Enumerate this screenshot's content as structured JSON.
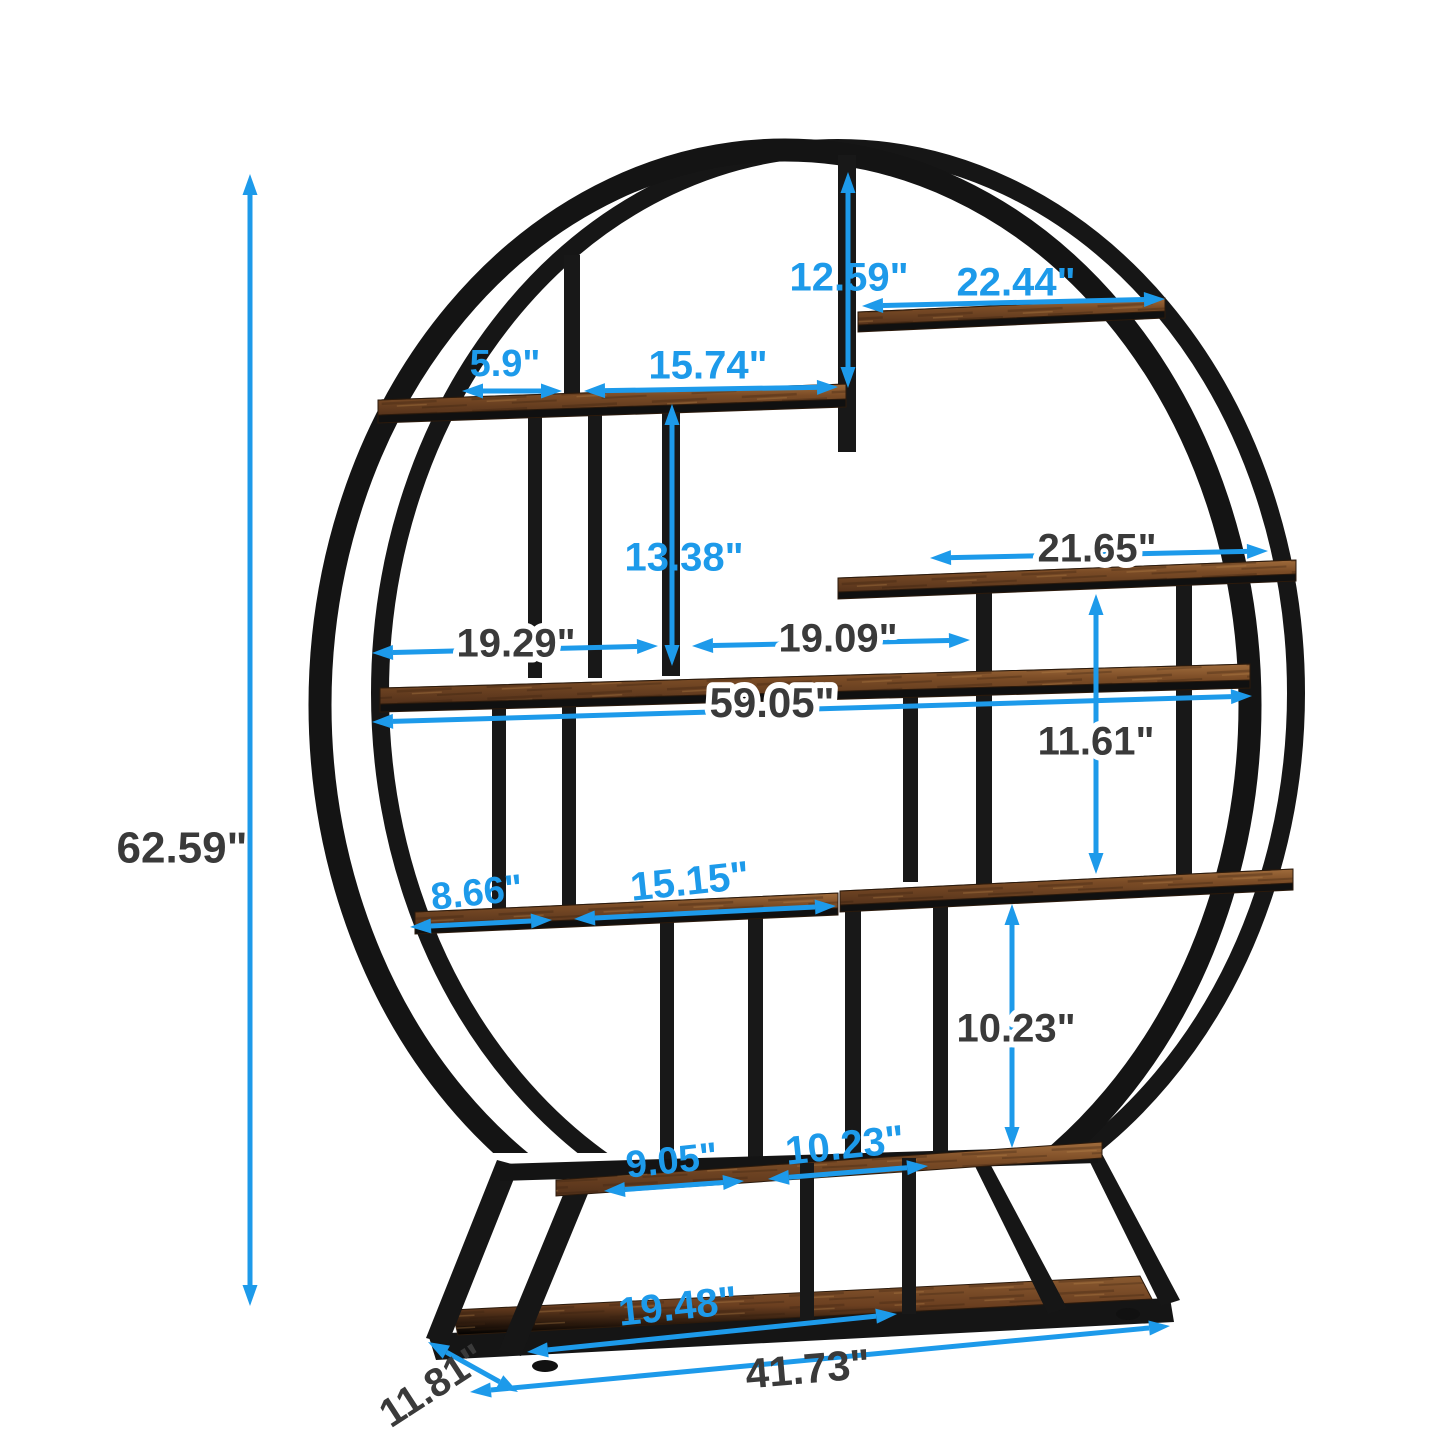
{
  "diagram": {
    "type": "product-dimension-diagram",
    "unit": "inches",
    "colors": {
      "dimension_blue": "#1d9aea",
      "dimension_dark": "#3a3a3a",
      "metal_black": "#1a1a1a",
      "wood_light": "#9c6a3c",
      "wood_mid": "#7b4c26",
      "wood_dark": "#53311a",
      "background": "#ffffff"
    },
    "dimensions": [
      {
        "name": "overall-height",
        "label": "62.59\"",
        "color": "dark",
        "lx": 182,
        "ly": 851,
        "rot": 0,
        "size": 44,
        "halo": false,
        "segments": [
          {
            "x1": 250,
            "y1": 174,
            "x2": 250,
            "y2": 1306,
            "a1": true,
            "a2": true
          }
        ]
      },
      {
        "name": "top-post-height",
        "label": "12.59\"",
        "color": "blue",
        "lx": 849,
        "ly": 280,
        "rot": 0,
        "size": 40,
        "halo": false,
        "segments": [
          {
            "x1": 848,
            "y1": 172,
            "x2": 848,
            "y2": 388,
            "a1": true,
            "a2": true
          }
        ]
      },
      {
        "name": "top-shelf-width",
        "label": "22.44\"",
        "color": "blue",
        "lx": 1016,
        "ly": 285,
        "rot": 0,
        "size": 40,
        "halo": false,
        "segments": [
          {
            "x1": 862,
            "y1": 306,
            "x2": 1165,
            "y2": 299,
            "a1": true,
            "a2": true
          }
        ]
      },
      {
        "name": "upper-shelf-left-segment",
        "label": "5.9\"",
        "color": "blue",
        "lx": 505,
        "ly": 366,
        "rot": 0,
        "size": 38,
        "halo": false,
        "segments": [
          {
            "x1": 462,
            "y1": 391,
            "x2": 562,
            "y2": 391,
            "a1": true,
            "a2": true
          }
        ]
      },
      {
        "name": "upper-shelf-right-segment",
        "label": "15.74\"",
        "color": "blue",
        "lx": 708,
        "ly": 368,
        "rot": 0,
        "size": 40,
        "halo": false,
        "segments": [
          {
            "x1": 584,
            "y1": 391,
            "x2": 838,
            "y2": 387,
            "a1": true,
            "a2": true
          }
        ]
      },
      {
        "name": "mid-post-height",
        "label": "13.38\"",
        "color": "blue",
        "lx": 684,
        "ly": 560,
        "rot": 0,
        "size": 40,
        "halo": false,
        "segments": [
          {
            "x1": 672,
            "y1": 404,
            "x2": 672,
            "y2": 666,
            "a1": true,
            "a2": true
          }
        ]
      },
      {
        "name": "right-shelf-width",
        "label": "21.65\"",
        "color": "dark",
        "lx": 1097,
        "ly": 551,
        "rot": 0,
        "size": 40,
        "halo": true,
        "segments": [
          {
            "x1": 930,
            "y1": 558,
            "x2": 1268,
            "y2": 551,
            "a1": true,
            "a2": true
          }
        ]
      },
      {
        "name": "middle-shelf-left-segment",
        "label": "19.29\"",
        "color": "dark",
        "lx": 516,
        "ly": 646,
        "rot": 0,
        "size": 40,
        "halo": true,
        "segments": [
          {
            "x1": 372,
            "y1": 653,
            "x2": 658,
            "y2": 646,
            "a1": true,
            "a2": true
          }
        ]
      },
      {
        "name": "middle-shelf-right-segment",
        "label": "19.09\"",
        "color": "dark",
        "lx": 838,
        "ly": 641,
        "rot": 0,
        "size": 40,
        "halo": true,
        "segments": [
          {
            "x1": 692,
            "y1": 646,
            "x2": 970,
            "y2": 640,
            "a1": true,
            "a2": true
          }
        ]
      },
      {
        "name": "overall-width",
        "label": "59.05\"",
        "color": "dark",
        "lx": 772,
        "ly": 706,
        "rot": 0,
        "size": 42,
        "halo": true,
        "segments": [
          {
            "x1": 372,
            "y1": 722,
            "x2": 1252,
            "y2": 696,
            "a1": true,
            "a2": true
          }
        ]
      },
      {
        "name": "right-gap-height",
        "label": "11.61\"",
        "color": "dark",
        "lx": 1096,
        "ly": 744,
        "rot": 0,
        "size": 40,
        "halo": true,
        "segments": [
          {
            "x1": 1096,
            "y1": 594,
            "x2": 1096,
            "y2": 874,
            "a1": true,
            "a2": true
          }
        ]
      },
      {
        "name": "lower-shelf-left-segment",
        "label": "8.66\"",
        "color": "blue",
        "lx": 477,
        "ly": 895,
        "rot": -6,
        "size": 38,
        "halo": false,
        "segments": [
          {
            "x1": 410,
            "y1": 927,
            "x2": 552,
            "y2": 920,
            "a1": true,
            "a2": true
          }
        ]
      },
      {
        "name": "lower-shelf-right-segment",
        "label": "15.15\"",
        "color": "blue",
        "lx": 690,
        "ly": 884,
        "rot": -6,
        "size": 40,
        "halo": false,
        "segments": [
          {
            "x1": 574,
            "y1": 919,
            "x2": 836,
            "y2": 906,
            "a1": true,
            "a2": true
          }
        ]
      },
      {
        "name": "lower-right-gap-height",
        "label": "10.23\"",
        "color": "dark",
        "lx": 1016,
        "ly": 1031,
        "rot": 0,
        "size": 40,
        "halo": true,
        "segments": [
          {
            "x1": 1012,
            "y1": 904,
            "x2": 1012,
            "y2": 1148,
            "a1": true,
            "a2": true
          }
        ]
      },
      {
        "name": "bottom-shelf-left-segment",
        "label": "9.05\"",
        "color": "blue",
        "lx": 672,
        "ly": 1163,
        "rot": -6,
        "size": 38,
        "halo": false,
        "segments": [
          {
            "x1": 604,
            "y1": 1191,
            "x2": 744,
            "y2": 1181,
            "a1": true,
            "a2": true
          }
        ]
      },
      {
        "name": "bottom-shelf-right-segment",
        "label": "10.23\"",
        "color": "blue",
        "lx": 845,
        "ly": 1148,
        "rot": -6,
        "size": 40,
        "halo": false,
        "segments": [
          {
            "x1": 768,
            "y1": 1179,
            "x2": 928,
            "y2": 1166,
            "a1": true,
            "a2": true
          }
        ]
      },
      {
        "name": "base-shelf-width",
        "label": "19.48\"",
        "color": "blue",
        "lx": 678,
        "ly": 1309,
        "rot": -6,
        "size": 40,
        "halo": false,
        "segments": [
          {
            "x1": 527,
            "y1": 1352,
            "x2": 897,
            "y2": 1314,
            "a1": true,
            "a2": true
          }
        ]
      },
      {
        "name": "base-depth",
        "label": "11.81\"",
        "color": "dark",
        "lx": 434,
        "ly": 1388,
        "rot": -33,
        "size": 40,
        "halo": false,
        "segments": [
          {
            "x1": 428,
            "y1": 1342,
            "x2": 518,
            "y2": 1392,
            "a1": true,
            "a2": true
          }
        ]
      },
      {
        "name": "base-width",
        "label": "41.73\"",
        "color": "dark",
        "lx": 808,
        "ly": 1372,
        "rot": -5,
        "size": 42,
        "halo": false,
        "segments": [
          {
            "x1": 470,
            "y1": 1392,
            "x2": 1170,
            "y2": 1326,
            "a1": true,
            "a2": true
          }
        ]
      }
    ]
  }
}
